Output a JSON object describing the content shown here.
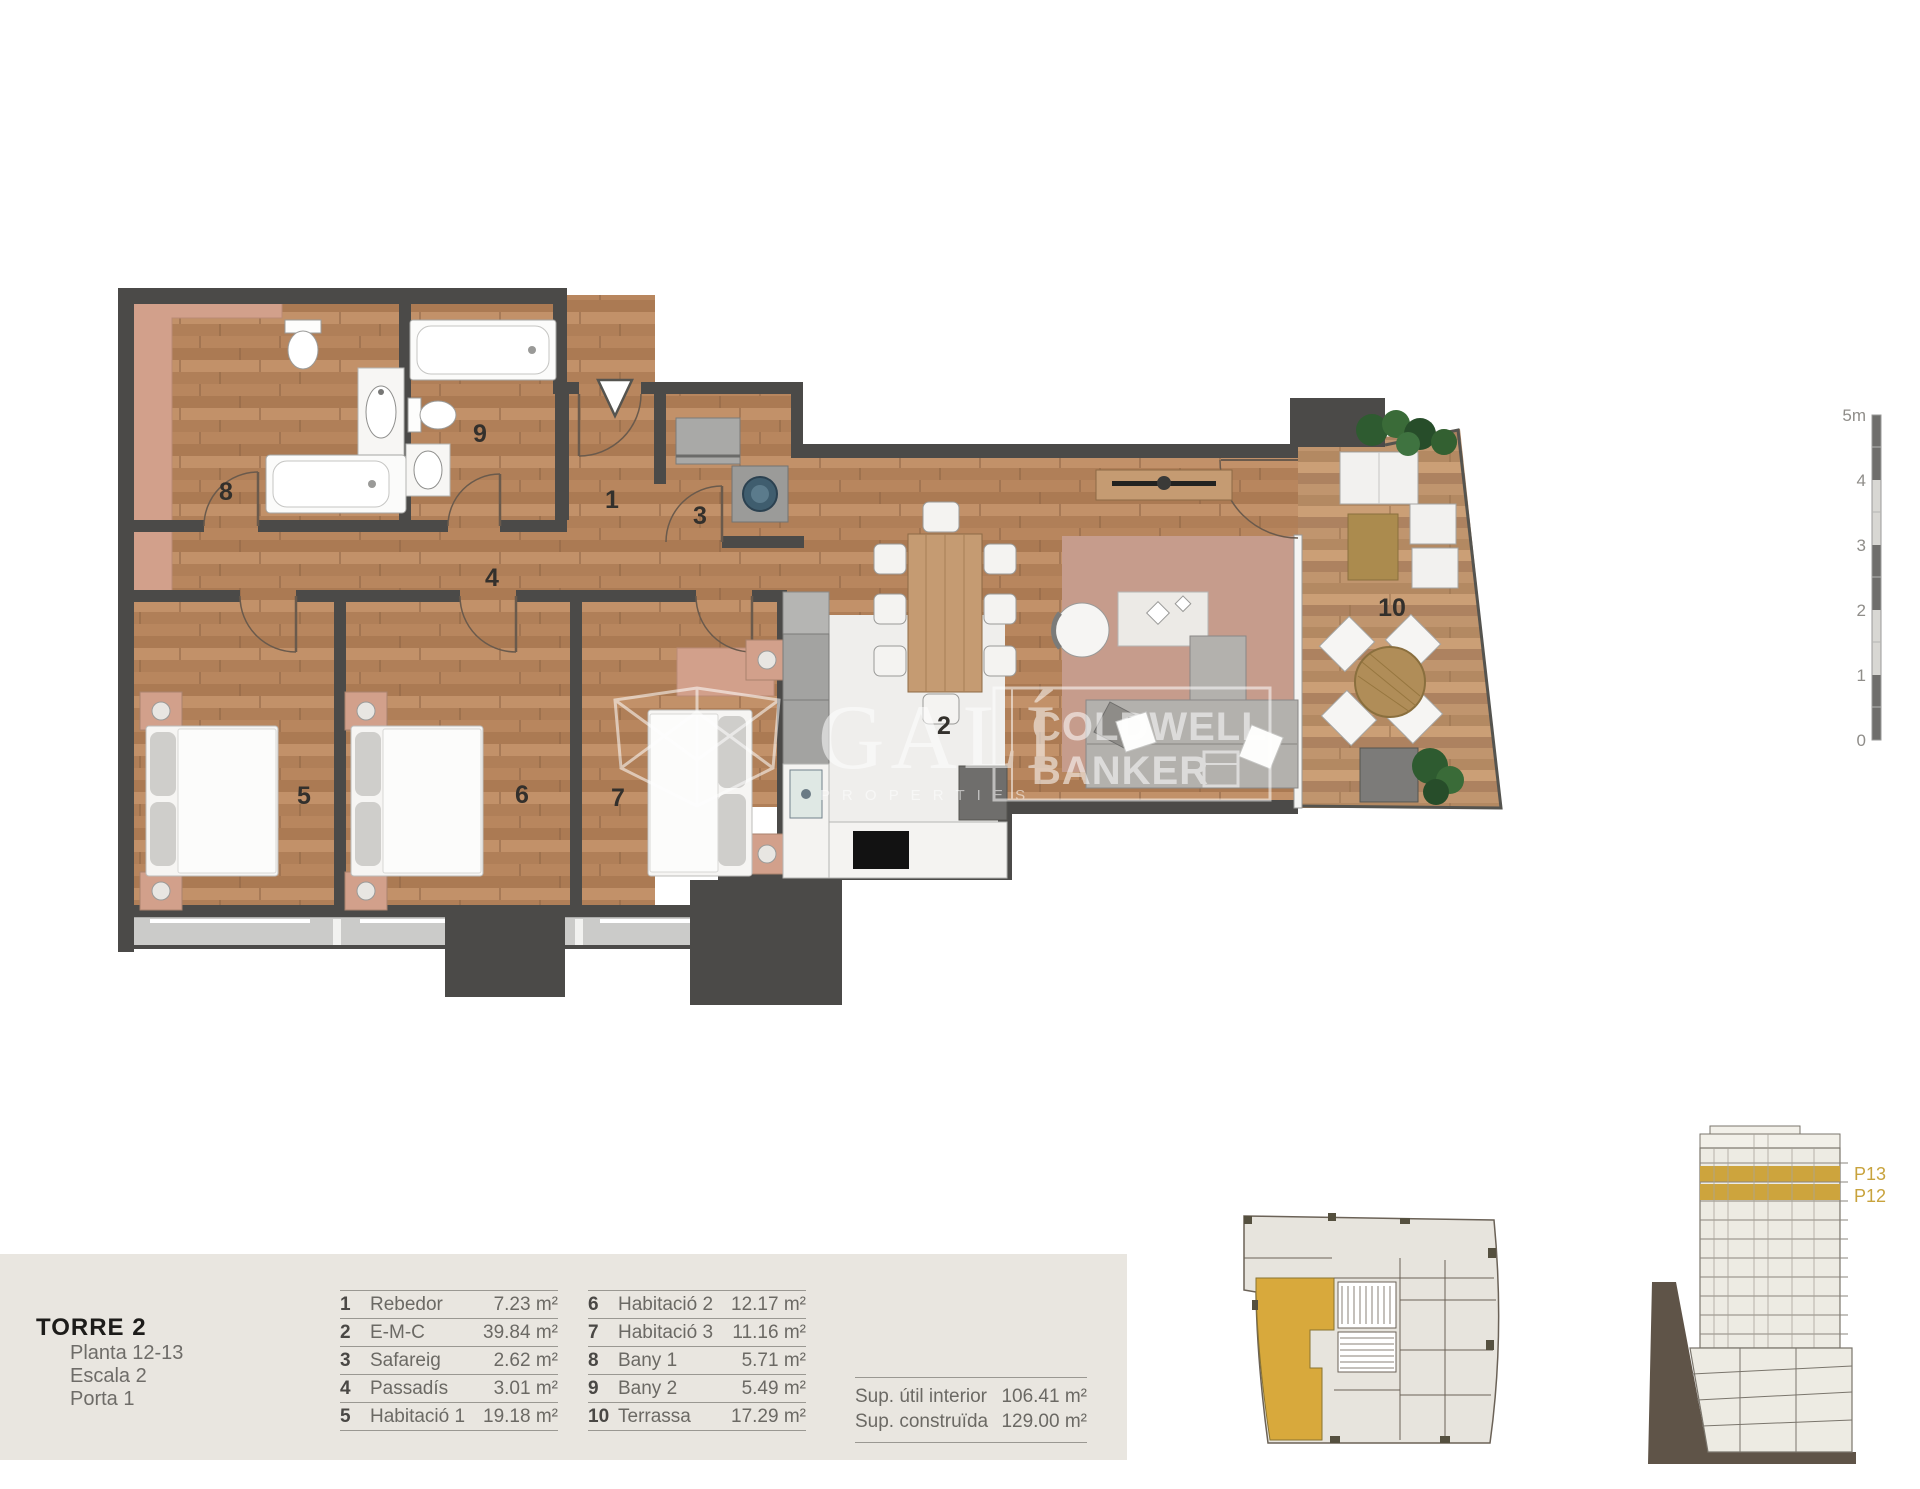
{
  "rooms": [
    "1",
    "2",
    "3",
    "4",
    "5",
    "6",
    "7",
    "8",
    "9",
    "10"
  ],
  "legend": {
    "left": [
      {
        "num": "1",
        "name": "Rebedor",
        "area": "7.23 m²"
      },
      {
        "num": "2",
        "name": "E-M-C",
        "area": "39.84 m²"
      },
      {
        "num": "3",
        "name": "Safareig",
        "area": "2.62 m²"
      },
      {
        "num": "4",
        "name": "Passadís",
        "area": "3.01 m²"
      },
      {
        "num": "5",
        "name": "Habitació 1",
        "area": "19.18 m²"
      }
    ],
    "right": [
      {
        "num": "6",
        "name": "Habitació 2",
        "area": "12.17 m²"
      },
      {
        "num": "7",
        "name": "Habitació 3",
        "area": "11.16 m²"
      },
      {
        "num": "8",
        "name": "Bany 1",
        "area": "5.71 m²"
      },
      {
        "num": "9",
        "name": "Bany 2",
        "area": "5.49 m²"
      },
      {
        "num": "10",
        "name": "Terrassa",
        "area": "17.29 m²"
      }
    ]
  },
  "title_block": {
    "title": "TORRE 2",
    "line1": "Planta 12-13",
    "line2": "Escala 2",
    "line3": "Porta 1"
  },
  "summary": {
    "row1_label": "Sup. útil interior",
    "row1_value": "106.41 m²",
    "row2_label": "Sup. construïda",
    "row2_value": "129.00 m²"
  },
  "scale_bar": {
    "l0": "5m",
    "l1": "4",
    "l2": "3",
    "l3": "2",
    "l4": "1",
    "l5": "0"
  },
  "section": {
    "f1": "P13",
    "f2": "P12"
  },
  "watermarks": {
    "brand": "GALÍ",
    "brand_sub": "P R O P E R T I E S",
    "cb1": "COLDWELL",
    "cb2": "BANKER"
  },
  "colors": {
    "wall": "#4b4a48",
    "wood": "#b4855f",
    "accent_pink": "#d2a08b",
    "highlight_gold": "#d0a73d",
    "text_grey": "#6b6964"
  }
}
